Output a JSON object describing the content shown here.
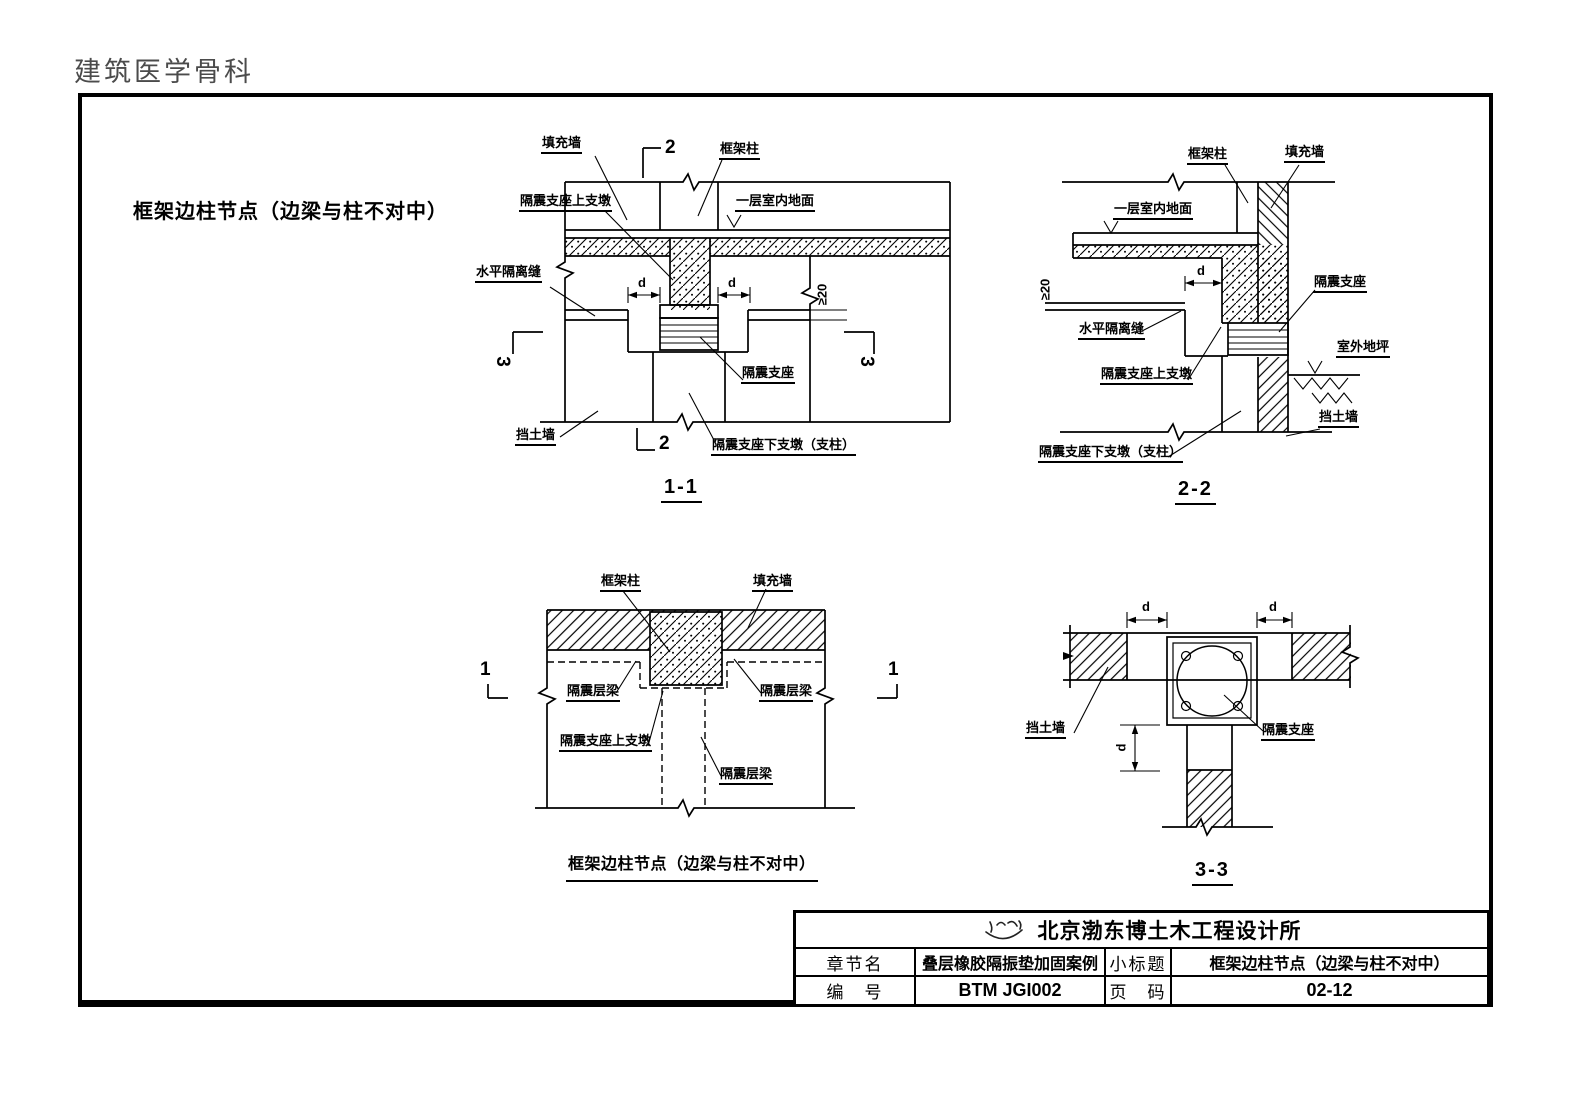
{
  "page": {
    "header": "建筑医学骨科",
    "figure_title": "框架边柱节点（边梁与柱不对中）"
  },
  "labels": {
    "fill_wall": "填充墙",
    "frame_column": "框架柱",
    "upper_pier": "隔震支座上支墩",
    "indoor_floor": "一层室内地面",
    "horizontal_joint": "水平隔离缝",
    "isolator": "隔震支座",
    "retaining_wall": "挡土墙",
    "lower_pier": "隔震支座下支墩（支柱）",
    "outdoor_ground": "室外地坪",
    "iso_beam": "隔震层梁",
    "dim_d": "d",
    "dim_min20": "≥20"
  },
  "marks": {
    "one": "1",
    "two": "2",
    "three": "3"
  },
  "captions": {
    "s11": "1-1",
    "s22": "2-2",
    "s33": "3-3",
    "plan": "框架边柱节点（边梁与柱不对中）"
  },
  "titleblock": {
    "company": "北京渤东博土木工程设计所",
    "logo": "calligraphy-signature",
    "chapter_label": "章节名",
    "chapter_value": "叠层橡胶隔振垫加固案例",
    "subtitle_label": "小标题",
    "subtitle_value": "框架边柱节点（边梁与柱不对中）",
    "number_label": "编　号",
    "number_value": "BTM JGI002",
    "page_label": "页　码",
    "page_value": "02-12"
  }
}
